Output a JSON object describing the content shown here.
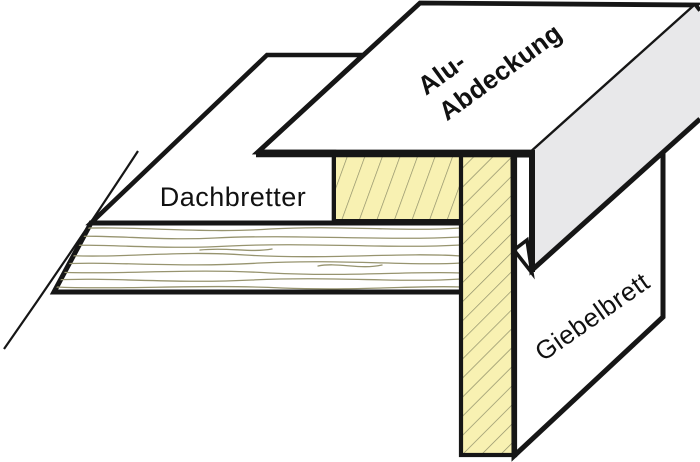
{
  "diagram": {
    "type": "technical-construction-detail",
    "subject": "roof verge (Ortgang) aluminium capping detail, oblique 3D section view",
    "labels": {
      "roof_boards": "Dachbretter",
      "alu_cover_line1": "Alu-",
      "alu_cover_line2": "Abdeckung",
      "gable_board": "Giebelbrett"
    },
    "colors": {
      "wood": "#f8f1b2",
      "aluminum": "#e8e8ea",
      "outline": "#161616",
      "hatch": "#8d8d68",
      "grain": "#97946f",
      "background": "#ffffff"
    }
  }
}
